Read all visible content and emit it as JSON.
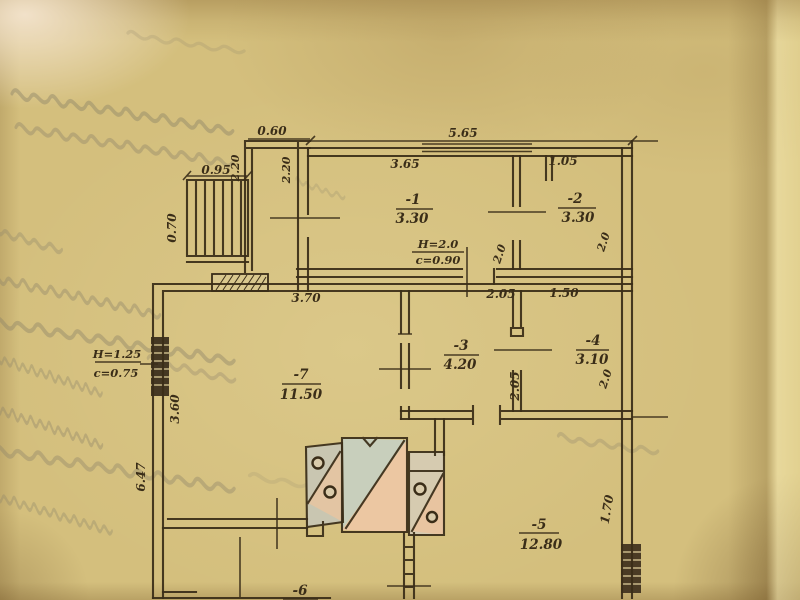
{
  "colors": {
    "paper": "#d4bf7d",
    "ink": "#3a2d18",
    "stove_green": "#c8cfbc",
    "stove_pink": "#ecc7a2",
    "stove_gray": "#c9c6b1",
    "window_dark": "#453823"
  },
  "rooms": [
    {
      "number": "-1",
      "area": "3.30"
    },
    {
      "number": "-2",
      "area": "3.30"
    },
    {
      "number": "-3",
      "area": "4.20"
    },
    {
      "number": "-4",
      "area": "3.10"
    },
    {
      "number": "-5",
      "area": "12.80"
    },
    {
      "number": "-6",
      "area": ""
    },
    {
      "number": "-7",
      "area": "11.50"
    }
  ],
  "labels": {
    "stair_width": "0.95",
    "stair_depth": "0.70",
    "porch_width": "0.60",
    "porch_side_left": "2.20",
    "porch_side_right": "2.20",
    "front_total": "5.65",
    "room1_width": "3.65",
    "room2_segment": "1.05",
    "hall_depth": "2.0",
    "room2_depth": "2.0",
    "room7_width": "3.70",
    "room3_segment": "2.05",
    "room4_segment": "1.50",
    "room3_depth": "2.05",
    "room4_depth": "2.0",
    "left_side_upper": "3.60",
    "left_side_lower": "6.47",
    "room5_side": "1.70"
  },
  "openings": {
    "door_main": {
      "height": "H=2.0",
      "clear": "c=0.90"
    },
    "window_left": {
      "height": "H=1.25",
      "clear": "c=0.75"
    }
  }
}
